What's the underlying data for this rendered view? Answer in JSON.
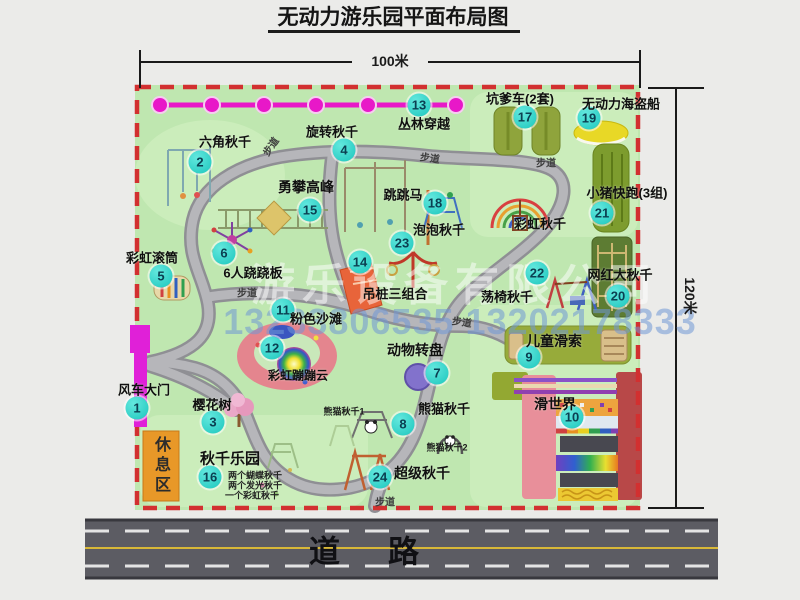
{
  "title": "无动力游乐园平面布局图",
  "dim_width": "100米",
  "dim_height": "120米",
  "road": "道路",
  "footpath": "步道",
  "rest_area": "休息区",
  "rainbow_swing_extra": "彩虹秋千",
  "panda_swing_1": "熊猫秋千1",
  "panda_swing_2": "熊猫秋千2",
  "swing_park_notes": [
    "两个蝴蝶秋千",
    "两个发光秋千",
    "一个彩虹秋千"
  ],
  "watermark": {
    "company": "游乐设备有限公司",
    "phone": "13233806535 13202178333"
  },
  "attractions": [
    {
      "num": "1",
      "label": "风车大门"
    },
    {
      "num": "2",
      "label": "六角秋千"
    },
    {
      "num": "3",
      "label": "樱花树"
    },
    {
      "num": "4",
      "label": "旋转秋千"
    },
    {
      "num": "5",
      "label": "彩虹滚筒"
    },
    {
      "num": "6",
      "label": "6人跷跷板"
    },
    {
      "num": "7",
      "label": "动物转盘"
    },
    {
      "num": "8",
      "label": "熊猫秋千"
    },
    {
      "num": "9",
      "label": "儿童滑索"
    },
    {
      "num": "10",
      "label": "滑世界"
    },
    {
      "num": "11",
      "label": "粉色沙滩"
    },
    {
      "num": "12",
      "label": "彩虹蹦蹦云"
    },
    {
      "num": "13",
      "label": "丛林穿越"
    },
    {
      "num": "14",
      "label": "吊桩三组合"
    },
    {
      "num": "15",
      "label": "勇攀高峰"
    },
    {
      "num": "16",
      "label": "秋千乐园"
    },
    {
      "num": "17",
      "label": "坑爹车(2套)"
    },
    {
      "num": "18",
      "label": "跳跳马"
    },
    {
      "num": "19",
      "label": "无动力海盗船"
    },
    {
      "num": "20",
      "label": "网红大秋千"
    },
    {
      "num": "21",
      "label": "小猪快跑(3组)"
    },
    {
      "num": "22",
      "label": "荡椅秋千"
    },
    {
      "num": "23",
      "label": "泡泡秋千"
    },
    {
      "num": "24",
      "label": "超级秋千"
    }
  ],
  "colors": {
    "map_green": "#bfe7b0",
    "border_red": "#d23030",
    "zipline_magenta": "#e818c8",
    "badge_cyan": "#1cc6bd",
    "road_gray": "#5c5c63",
    "rest_area_orange": "#e89828"
  }
}
